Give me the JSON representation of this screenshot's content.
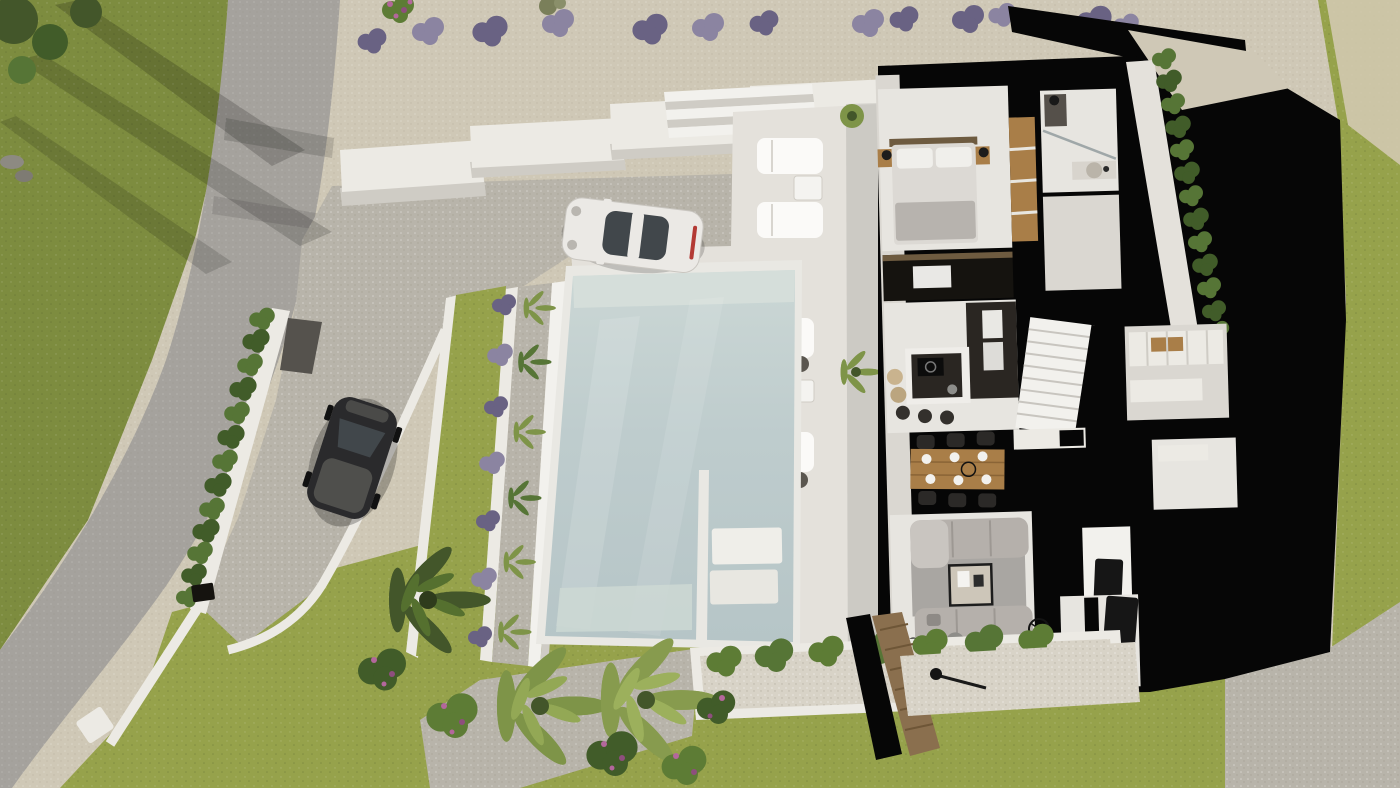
{
  "scene": {
    "title": "Aerial 3D render of a modern villa floor plan",
    "description": "Top-down photorealistic 3D rendering of a white modern villa with cut-away roof showing furnished interior (bedroom, bathroom, kitchen with island, staircase, dining table for six, living room with two sofas and TV wall), a large pale-blue infinity pool with sun loungers, stepped gravel driveway with a parked white sports car, a curving grey road with a parked black car, lavender bushes, conifer hedges, palm trees, flowering shrubs and lawns. Cut walls and terrain shadow render as solid black.",
    "objects": {
      "road": "curving access road",
      "black_car": "black car parked on driveway ramp",
      "white_car": "white sports car on gravel driveway",
      "pool": "infinity swimming pool with shallow platform section",
      "villa": "cut-away villa interior",
      "bedroom": "master bedroom with double bed",
      "bathroom": "bathroom with shower and round basin",
      "kitchen": "kitchen with dark island and tall oven units",
      "dining_area": "wooden dining table with six black chairs",
      "living_room": "living room with two grey sofas, rug and TV wall",
      "staircase": "white staircase",
      "wardrobe_corridor": "corridor with white wardrobes",
      "utility_room": "utility room with black door",
      "sun_loungers": "white sun loungers with side tables",
      "driveway": "speckled gravel driveway and ramp",
      "hedge_left": "conifer hedge along boundary wall",
      "hedge_right": "conifer hedge along rear wall",
      "lavender_row": "row of lavender bushes on upper gravel bank",
      "pool_garden": "stepped planter strip with lawn, lavender and dwarf palms",
      "palm_trees": "fan palm trees in lower garden",
      "flower_shrubs": "pink flowering shrubs",
      "planter": "white raised planter with green shrubs and pebbles",
      "wooden_fence": "wooden slat fence",
      "lawn": "olive-green lawn areas",
      "gate_lamp": "black gate lamp at boundary corner"
    }
  },
  "colors": {
    "grassSun": "#96a24b",
    "grassMid": "#7d8c3f",
    "grassShade": "#606f33",
    "road": "#a5a29d",
    "gravelTop": "#cfc8b6",
    "gravelDrive": "#b8b4aa",
    "pebble": "#d8d3c7",
    "sand": "#d6cbb6",
    "wallWhite": "#eceae4",
    "wallShade": "#cfccc5",
    "deckWhite": "#e4e1db",
    "stepLight": "#f2f1ed",
    "poolRim": "#e9e8e3",
    "poolWater": "#becccd",
    "poolWaterLight": "#d6dfda",
    "poolStep": "#cdd8d4",
    "cutBlack": "#060606",
    "floor": "#e7e5e0",
    "floorShade": "#dad7d1",
    "hedge": "#567536",
    "hedgeDark": "#415c29",
    "palm": "#7e9448",
    "palmDark": "#43562a",
    "lavender": "#8b84a1",
    "lavenderDark": "#696283",
    "flowerPink": "#b4679c",
    "flowerMagenta": "#8e4e7d",
    "shrubGreen": "#5d7c35",
    "wood": "#a97e48",
    "woodDark": "#6e5b40",
    "fenceWood": "#8a6f4e",
    "kitchenDark": "#2a2622",
    "mediaBlack": "#15130f",
    "sofa": "#b5b0ab",
    "sofaLight": "#c9c5c0",
    "rug": "#a9a6a2",
    "rugBeige": "#d6cab2",
    "carWhite": "#ebe9e5",
    "carGlass": "#41474b",
    "carBlack": "#2a2a2c",
    "tvDark": "#161616",
    "shadow": "#000000"
  }
}
